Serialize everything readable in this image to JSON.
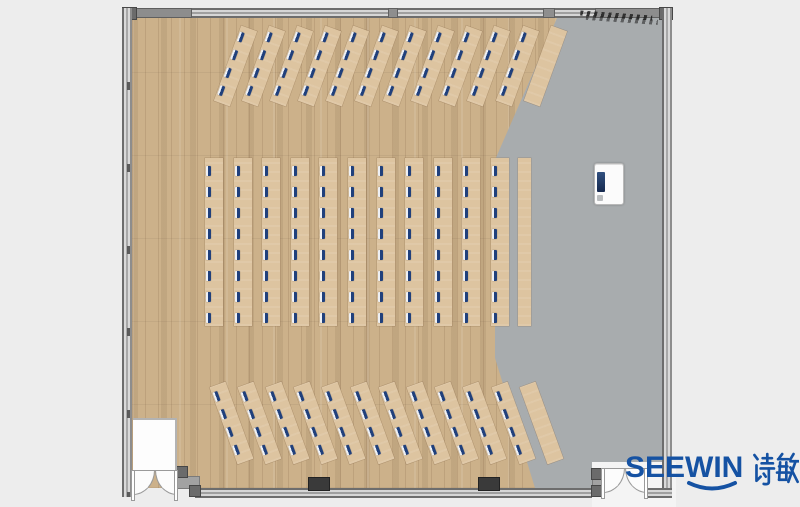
{
  "logo": {
    "brand": "SEEWIN",
    "brand_cn": "诗敏",
    "color": "#1552a3"
  },
  "colors": {
    "background": "#ededed",
    "wood_floor": "#ccb18a",
    "gray_floor": "#a8acae",
    "desk": "#ddc4a0",
    "monitor_navy": "#20407c",
    "wall_gray": "#8d8d8d"
  },
  "plan": {
    "type": "classroom-floor-plan-top-view",
    "desk_sections": [
      {
        "id": "top",
        "name": "front angled desk rows",
        "rows": 12,
        "monitored_rows": 11,
        "monitors_per_row": 4,
        "angle_deg": 20
      },
      {
        "id": "middle",
        "name": "center straight desk columns",
        "rows": 11,
        "monitored_rows": 11,
        "monitors_per_row": 8,
        "angle_deg": 0,
        "side_table": true
      },
      {
        "id": "bottom",
        "name": "rear angled desk rows",
        "rows": 12,
        "monitored_rows": 11,
        "monitors_per_row": 4,
        "angle_deg": -20
      }
    ],
    "fixtures": [
      {
        "id": "podium",
        "name": "presenter-station"
      },
      {
        "id": "planter",
        "name": "hand-drawn-plant-sketch"
      }
    ],
    "doors": [
      {
        "id": "bl",
        "name": "double-door-bottom-left"
      },
      {
        "id": "br",
        "name": "double-door-bottom-right"
      }
    ]
  }
}
